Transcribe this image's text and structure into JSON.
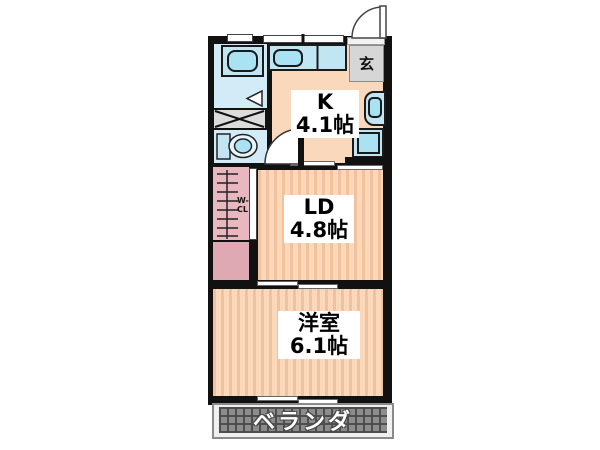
{
  "rooms": {
    "kitchen": {
      "abbr": "K",
      "area": "4.1帖"
    },
    "living_dining": {
      "abbr": "LD",
      "area": "4.8帖"
    },
    "western_room": {
      "name": "洋室",
      "area": "6.1帖"
    }
  },
  "entrance": {
    "label": "玄"
  },
  "closet": {
    "label_line1": "W-",
    "label_line2": "CL"
  },
  "veranda": {
    "label": "ベランダ"
  },
  "fixtures": {
    "bathtub": "bathtub-icon",
    "kitchen_sink": "kitchen-sink-icon",
    "toilet": "toilet-icon",
    "wash_basin": "wash-basin-icon",
    "washing_machine_pan": "washing-machine-pan-icon",
    "laundry_space": "cross-box-icon",
    "closet_pole": "ladder-pole-icon",
    "entry_door": "door-swing-icon",
    "inner_door": "door-swing-icon",
    "bath_door": "triangle-door-icon"
  },
  "colors": {
    "wall": "#111111",
    "room_floor": "#F9D8BC",
    "floor_stripe": "#F2C29C",
    "wet_area_floor": "#D3EBF7",
    "fixture_fill": "#C2E5F4",
    "fixture_inner": "#A9E3F3",
    "closet_pink": "#E8B7C0",
    "closet_pink_solid": "#DFA9B4",
    "entrance_gray": "#D6D6D6",
    "veranda_tile": "#8C8C8C",
    "veranda_grid": "#4E4E4E"
  }
}
